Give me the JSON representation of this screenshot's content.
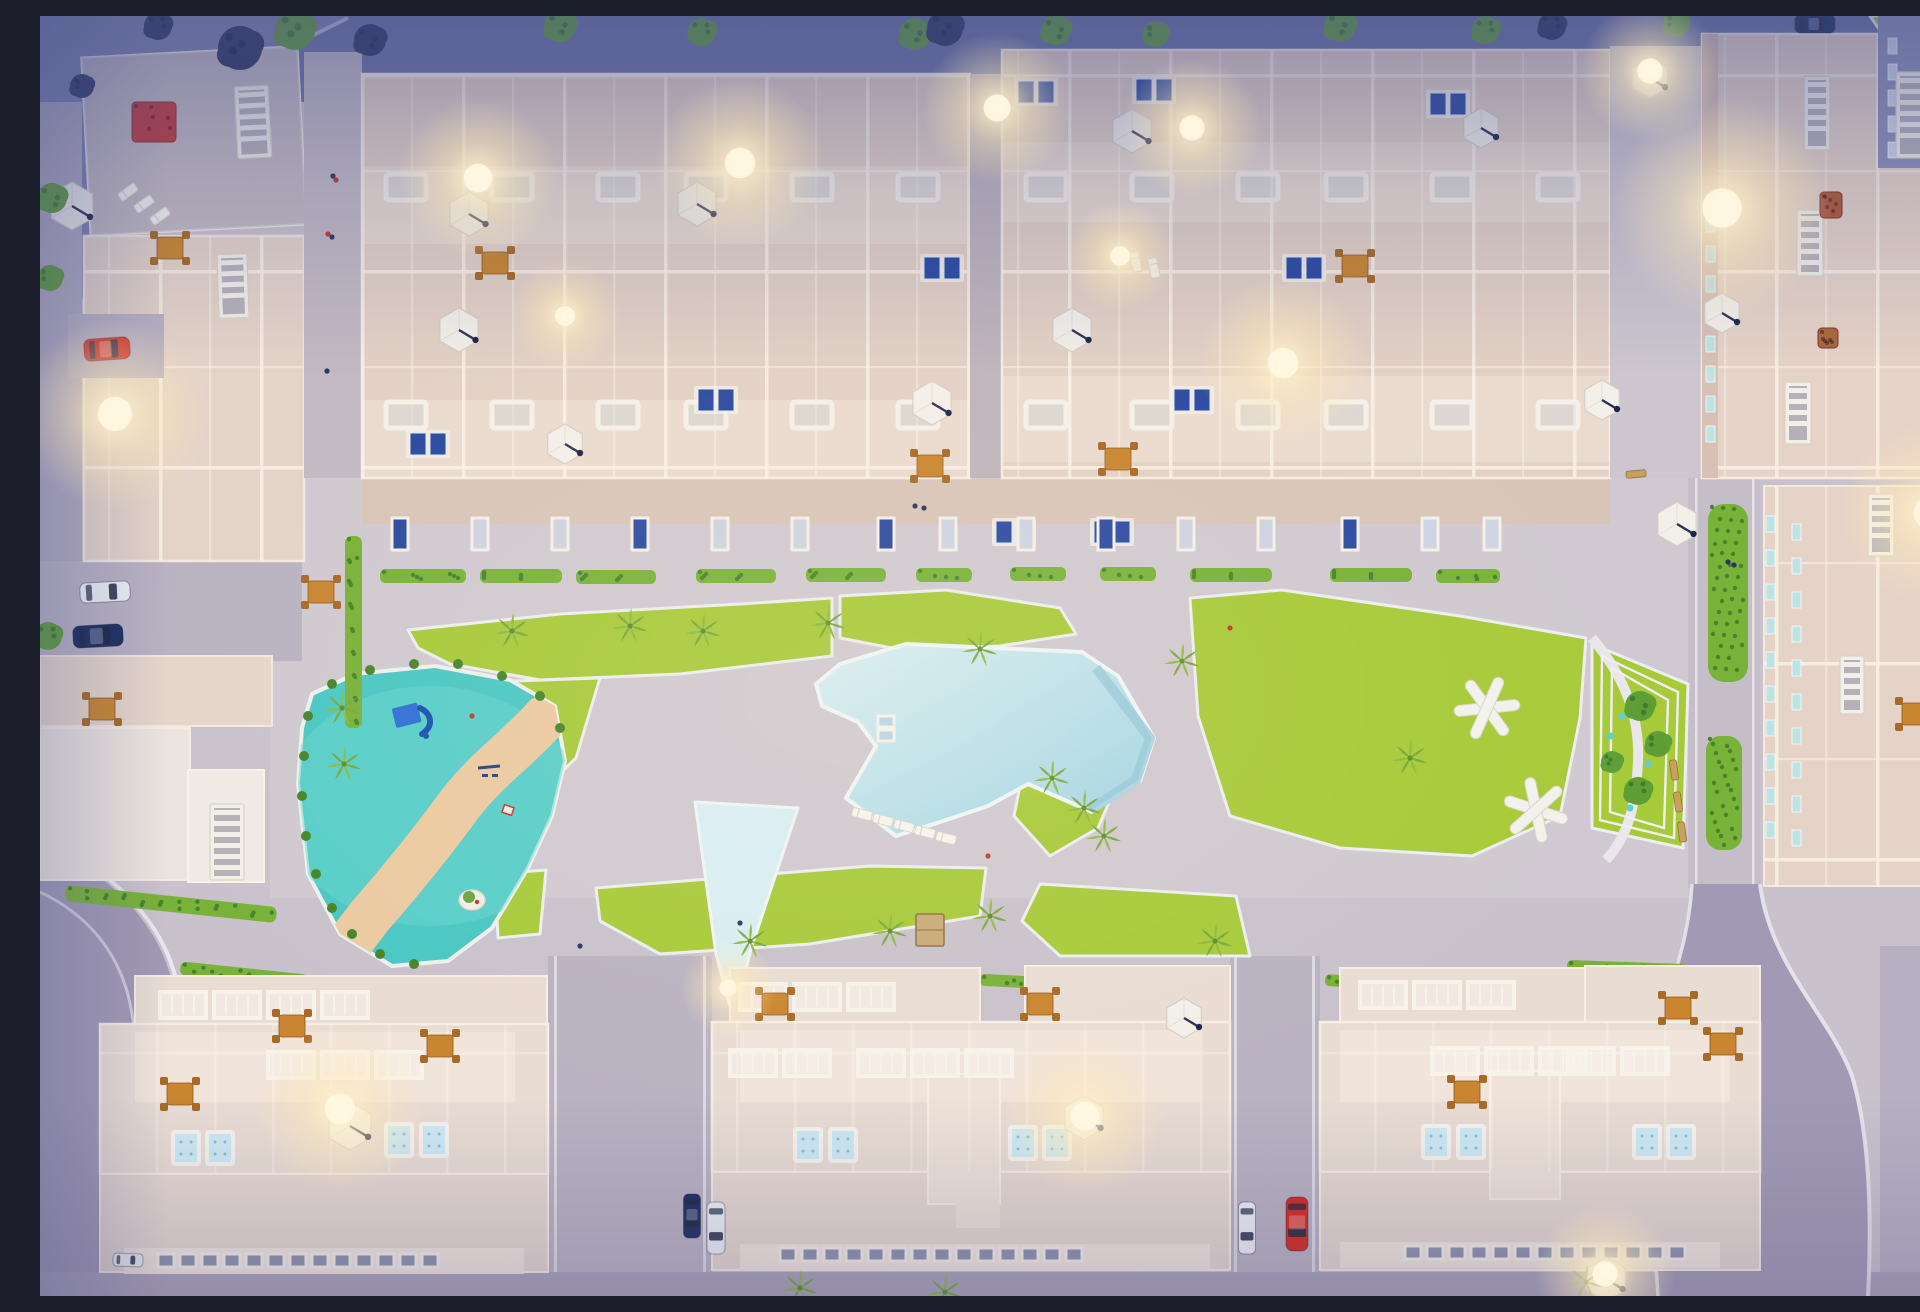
{
  "meta": {
    "title": "Aerial dusk render of residential complex",
    "description": "Top-down 3D architectural rendering at dusk: rows of cream apartment buildings with lit rooftop terraces, parasols and plunge pools around a central courtyard with a large free-form swimming pool, lawns with palm trees, a teal playground with a winding sand path, picnic structures on the right lawn, and perimeter streets with parked cars"
  },
  "palette": {
    "plaza": "#c9c2cc",
    "dusk": "#6b72a4",
    "dusk2": "#7d82ae",
    "roadPurple": "#a29ab4",
    "roadSide": "#b9b2c2",
    "brick": "#c2b9c3",
    "roofA": "#e3d1c5",
    "roofL": "#ddcfc9",
    "roofC": "#e6d3c7",
    "slab": "#e9dcd3",
    "slabLight": "#f1e4da",
    "facade": "#d9c5b8",
    "lawn": "#a7ca39",
    "hedge": "#79b238",
    "hedgeDark": "#46842a",
    "pool": "#b2dde9",
    "poolLight": "#d8eef4",
    "poolEdge": "#8fc6d8",
    "playTeal": "#49c7c3",
    "playTealLight": "#68d5d0",
    "sand": "#eccaa2",
    "umbrella": "#f3f0ea",
    "carRed": "#d4291d",
    "carBlue": "#2a4fb4",
    "carNavy": "#1c2d5e",
    "carWhite": "#eef0f4",
    "glow": "#ffe9b8",
    "treeGreen": "#5f9e37",
    "treeDark": "#3f7d2b",
    "treeNavy": "#2c3560",
    "palm": "#8fba43",
    "orange": "#c9852f",
    "panelBlue": "#2b4aa0",
    "tealWin": "#bfe3e3"
  },
  "scene": {
    "lawns": [
      {
        "points": "368,614 520,598 700,588 792,582 792,640 640,658 500,664 410,648 378,632"
      },
      {
        "points": "800,580 906,574 1020,592 1036,618 960,630 862,634 800,622"
      },
      {
        "points": "390,668 560,662 536,742 470,806 422,772 396,700"
      },
      {
        "points": "985,745 1052,736 1076,770 1058,812 1010,840 974,800"
      },
      {
        "points": "1150,582 1242,574 1420,600 1546,622 1540,702 1520,800 1432,840 1300,832 1190,800 1158,700"
      },
      {
        "points": "1552,628 1648,668 1643,832 1552,812"
      },
      {
        "points": "556,872 830,850 946,852 940,900 770,928 620,938 560,905"
      },
      {
        "points": "1000,868 1196,880 1210,940 1020,940 982,905"
      },
      {
        "points": "455,858 506,854 500,918 458,922"
      },
      {
        "points": "1896,1004 1920,998 1920,1106 1900,1108"
      },
      {
        "points": "1830,0 1920,0 1920,36 1845,22"
      }
    ],
    "pool": {
      "main": "800,648 866,628 1042,636 1078,660 1114,722 1100,765 1052,796 988,768 948,790 900,806 856,820 806,782 836,730 818,706 782,690 776,668",
      "shallow": "655,786 758,792 712,930 693,1002 676,938",
      "step_path": "M1056,652 L1110,722 L1096,764 L1050,794",
      "skylights": [
        [
          838,
          700
        ],
        [
          838,
          714
        ]
      ]
    },
    "playground": {
      "outline": "272,678 315,658 395,650 470,664 515,690 525,745 512,800 488,852 452,912 408,945 352,950 300,918 268,858 258,768 262,712",
      "sand_path": "M505,702 C472,738 448,752 420,788 C398,818 372,852 330,900 L310,926",
      "bushes": [
        [
          268,
          700
        ],
        [
          264,
          740
        ],
        [
          262,
          780
        ],
        [
          266,
          820
        ],
        [
          276,
          858
        ],
        [
          292,
          892
        ],
        [
          312,
          918
        ],
        [
          340,
          938
        ],
        [
          374,
          948
        ],
        [
          292,
          668
        ],
        [
          330,
          654
        ],
        [
          374,
          648
        ],
        [
          418,
          648
        ],
        [
          462,
          660
        ],
        [
          500,
          680
        ],
        [
          520,
          712
        ]
      ],
      "slide": [
        372,
        700
      ],
      "swing": [
        448,
        758
      ],
      "island": [
        432,
        884
      ],
      "toy": [
        468,
        794
      ]
    },
    "garden": {
      "fences": [
        "1562,640 1638,676 1634,822 1560,804",
        "1572,652 1628,684 1624,812 1570,796"
      ],
      "path": "M1552,622 C1584,660 1600,700 1598,745 C1596,790 1588,820 1566,844",
      "teal_dots": [
        [
          1582,
          700
        ],
        [
          1608,
          748
        ],
        [
          1590,
          792
        ],
        [
          1570,
          720
        ]
      ]
    },
    "hedges": [
      [
        340,
        553,
        86,
        14,
        0
      ],
      [
        440,
        553,
        82,
        14,
        0
      ],
      [
        536,
        554,
        80,
        14,
        0
      ],
      [
        656,
        553,
        80,
        14,
        0
      ],
      [
        766,
        552,
        80,
        14,
        0
      ],
      [
        876,
        552,
        56,
        14,
        0
      ],
      [
        970,
        551,
        56,
        14,
        0
      ],
      [
        1060,
        551,
        56,
        14,
        0
      ],
      [
        1150,
        552,
        82,
        14,
        0
      ],
      [
        1290,
        552,
        82,
        14,
        0
      ],
      [
        1396,
        553,
        64,
        14,
        0
      ],
      [
        305,
        520,
        17,
        192,
        0
      ],
      [
        273,
        60,
        10,
        370,
        0
      ],
      [
        25,
        880,
        212,
        16,
        6
      ],
      [
        140,
        952,
        128,
        14,
        6
      ],
      [
        705,
        962,
        56,
        12,
        3
      ],
      [
        940,
        961,
        126,
        12,
        3
      ],
      [
        1090,
        962,
        66,
        12,
        3
      ],
      [
        1285,
        960,
        74,
        12,
        3
      ],
      [
        1527,
        946,
        120,
        12,
        2
      ],
      [
        1668,
        488,
        40,
        178,
        0
      ],
      [
        1666,
        720,
        36,
        114,
        0
      ],
      [
        1590,
        170,
        10,
        290,
        0
      ],
      [
        1646,
        60,
        10,
        400,
        0
      ],
      [
        935,
        130,
        8,
        310,
        0
      ]
    ],
    "glows": [
      [
        75,
        398,
        95
      ],
      [
        438,
        162,
        80
      ],
      [
        700,
        147,
        85
      ],
      [
        957,
        92,
        75
      ],
      [
        1152,
        112,
        70
      ],
      [
        1243,
        347,
        85
      ],
      [
        1610,
        55,
        70
      ],
      [
        1682,
        192,
        110
      ],
      [
        1890,
        497,
        90
      ],
      [
        300,
        1093,
        85
      ],
      [
        1045,
        1100,
        80
      ],
      [
        1565,
        1258,
        70
      ],
      [
        688,
        972,
        48
      ],
      [
        525,
        300,
        55
      ],
      [
        1080,
        240,
        55
      ]
    ],
    "umbrellas": [
      [
        32,
        190,
        24
      ],
      [
        429,
        198,
        22
      ],
      [
        419,
        314,
        22
      ],
      [
        657,
        188,
        22
      ],
      [
        525,
        428,
        20
      ],
      [
        1092,
        115,
        22
      ],
      [
        1032,
        314,
        22
      ],
      [
        892,
        387,
        22
      ],
      [
        1441,
        112,
        20
      ],
      [
        1610,
        62,
        20
      ],
      [
        1682,
        297,
        20
      ],
      [
        1562,
        384,
        20
      ],
      [
        1637,
        508,
        22
      ],
      [
        310,
        1110,
        24
      ],
      [
        1044,
        1102,
        22
      ],
      [
        1144,
        1002,
        20
      ],
      [
        1566,
        1263,
        22
      ]
    ],
    "cars": [
      {
        "x": 67,
        "y": 333,
        "w": 46,
        "h": 22,
        "rot": -4,
        "c": "red"
      },
      {
        "x": 65,
        "y": 576,
        "w": 50,
        "h": 20,
        "rot": -3,
        "c": "white"
      },
      {
        "x": 58,
        "y": 620,
        "w": 50,
        "h": 22,
        "rot": -3,
        "c": "navy"
      },
      {
        "x": 88,
        "y": 1244,
        "w": 30,
        "h": 13,
        "rot": 2,
        "c": "white"
      },
      {
        "x": 652,
        "y": 1200,
        "w": 44,
        "h": 17,
        "rot": 90,
        "c": "navy"
      },
      {
        "x": 676,
        "y": 1212,
        "w": 52,
        "h": 18,
        "rot": 90,
        "c": "white"
      },
      {
        "x": 1207,
        "y": 1212,
        "w": 52,
        "h": 17,
        "rot": 90,
        "c": "white"
      },
      {
        "x": 1257,
        "y": 1208,
        "w": 54,
        "h": 22,
        "rot": 90,
        "c": "red"
      },
      {
        "x": 1903,
        "y": 583,
        "w": 44,
        "h": 20,
        "rot": 90,
        "c": "navy"
      },
      {
        "x": 1900,
        "y": 640,
        "w": 40,
        "h": 20,
        "rot": 90,
        "c": "blue"
      },
      {
        "x": 1775,
        "y": 8,
        "w": 40,
        "h": 18,
        "rot": 0,
        "c": "navy"
      }
    ],
    "people": [
      [
        293,
        160,
        "n"
      ],
      [
        296,
        164,
        "r"
      ],
      [
        288,
        218,
        "r"
      ],
      [
        292,
        221,
        "n"
      ],
      [
        287,
        355,
        "n"
      ],
      [
        875,
        490,
        "n"
      ],
      [
        884,
        492,
        "n"
      ],
      [
        948,
        840,
        "r"
      ],
      [
        432,
        700,
        "r"
      ],
      [
        700,
        907,
        "n"
      ],
      [
        1688,
        546,
        "n"
      ],
      [
        1694,
        549,
        "n"
      ],
      [
        1190,
        612,
        "r"
      ],
      [
        540,
        930,
        "n"
      ]
    ],
    "trees": [
      [
        255,
        14,
        20
      ],
      [
        520,
        10,
        16
      ],
      [
        662,
        16,
        14
      ],
      [
        875,
        18,
        16
      ],
      [
        1016,
        14,
        15
      ],
      [
        1116,
        18,
        13
      ],
      [
        1300,
        10,
        16
      ],
      [
        1446,
        14,
        14
      ],
      [
        1636,
        8,
        13
      ],
      [
        1906,
        30,
        16
      ],
      [
        12,
        182,
        15
      ],
      [
        10,
        262,
        13
      ],
      [
        8,
        620,
        14
      ],
      [
        1600,
        690,
        15
      ],
      [
        1618,
        728,
        13
      ],
      [
        1598,
        775,
        14
      ],
      [
        1572,
        746,
        11
      ]
    ],
    "dark_trees": [
      [
        200,
        32,
        22
      ],
      [
        330,
        24,
        16
      ],
      [
        118,
        10,
        14
      ],
      [
        905,
        12,
        18
      ],
      [
        1512,
        10,
        14
      ],
      [
        42,
        70,
        12
      ]
    ],
    "palms": [
      [
        472,
        615
      ],
      [
        590,
        610
      ],
      [
        663,
        615
      ],
      [
        788,
        607
      ],
      [
        940,
        633
      ],
      [
        1142,
        645
      ],
      [
        1012,
        762
      ],
      [
        1044,
        792
      ],
      [
        1064,
        820
      ],
      [
        1370,
        742
      ],
      [
        302,
        692
      ],
      [
        304,
        748
      ],
      [
        710,
        925
      ],
      [
        850,
        915
      ],
      [
        950,
        900
      ],
      [
        1175,
        925
      ],
      [
        760,
        1272
      ],
      [
        905,
        1276
      ],
      [
        1546,
        1266
      ]
    ],
    "skylight_rows": [
      {
        "xs": [
          352,
          452,
          552,
          652,
          752,
          852
        ],
        "ys": [
          158,
          386
        ]
      },
      {
        "xs": [
          992,
          1092,
          1192,
          1292,
          1392,
          1492
        ],
        "ys": [
          158,
          386
        ]
      }
    ],
    "panels": [
      [
        676,
        384
      ],
      [
        996,
        76
      ],
      [
        1114,
        74
      ],
      [
        974,
        516
      ],
      [
        1072,
        516
      ],
      [
        902,
        252
      ],
      [
        1264,
        252
      ],
      [
        388,
        428
      ],
      [
        1408,
        88
      ],
      [
        1152,
        384
      ]
    ],
    "doors": {
      "xs": [
        352,
        432,
        512,
        592,
        672,
        752,
        838,
        900,
        978,
        1058,
        1138,
        1218,
        1302,
        1382,
        1444
      ],
      "y": 502
    },
    "facade_windows": [
      {
        "x": 1666,
        "y0": 200,
        "n": 8,
        "dy": 30
      },
      {
        "x": 1726,
        "y0": 500,
        "n": 10,
        "dy": 34
      },
      {
        "x": 1752,
        "y0": 508,
        "n": 10,
        "dy": 34
      },
      {
        "x": 1848,
        "y0": 22,
        "n": 5,
        "dy": 26
      }
    ],
    "stairs": [
      [
        196,
        70,
        34,
        72,
        -3
      ],
      [
        178,
        238,
        30,
        64,
        -2
      ],
      [
        170,
        788,
        34,
        76,
        0
      ],
      [
        1764,
        60,
        26,
        74,
        0
      ],
      [
        1757,
        194,
        26,
        66,
        0
      ],
      [
        1745,
        366,
        26,
        62,
        0
      ],
      [
        1856,
        56,
        30,
        86,
        0
      ],
      [
        1890,
        118,
        26,
        72,
        0
      ],
      [
        1828,
        478,
        26,
        62,
        0
      ],
      [
        1800,
        640,
        24,
        58,
        0
      ]
    ],
    "flowerbeds": [
      [
        92,
        86,
        44,
        40,
        "#c03a3a"
      ],
      [
        1780,
        176,
        22,
        26,
        "#b05a35"
      ],
      [
        1778,
        312,
        20,
        20,
        "#a86a3a"
      ]
    ],
    "tables": [
      [
        281,
        576
      ],
      [
        62,
        693
      ],
      [
        140,
        1078
      ],
      [
        400,
        1030
      ],
      [
        252,
        1010
      ],
      [
        735,
        988
      ],
      [
        1000,
        988
      ],
      [
        1427,
        1076
      ],
      [
        1638,
        992
      ],
      [
        1683,
        1028
      ],
      [
        890,
        450
      ],
      [
        1078,
        443
      ],
      [
        455,
        247
      ],
      [
        1315,
        250
      ],
      [
        1875,
        698
      ],
      [
        130,
        232
      ]
    ],
    "benches": [
      [
        1634,
        754,
        82
      ],
      [
        1638,
        786,
        82
      ],
      [
        1642,
        816,
        82
      ],
      [
        1596,
        458,
        -5
      ]
    ],
    "loungers": [
      [
        822,
        798,
        14
      ],
      [
        843,
        804,
        14
      ],
      [
        864,
        810,
        14
      ],
      [
        885,
        816,
        14
      ],
      [
        906,
        822,
        14
      ],
      [
        88,
        176,
        -36
      ],
      [
        104,
        188,
        -36
      ],
      [
        120,
        200,
        -36
      ],
      [
        1096,
        246,
        78
      ],
      [
        1114,
        252,
        78
      ]
    ],
    "xstructures": [
      [
        1447,
        692,
        -18
      ],
      [
        1496,
        794,
        6
      ]
    ],
    "rooftop_pools": [
      [
        133,
        1116
      ],
      [
        167,
        1116
      ],
      [
        346,
        1108
      ],
      [
        381,
        1108
      ],
      [
        755,
        1113
      ],
      [
        790,
        1113
      ],
      [
        970,
        1111
      ],
      [
        1004,
        1111
      ],
      [
        1383,
        1110
      ],
      [
        1418,
        1110
      ],
      [
        1594,
        1110
      ],
      [
        1628,
        1110
      ]
    ],
    "railings": [
      [
        228,
        1036,
        3
      ],
      [
        690,
        1034,
        2
      ],
      [
        818,
        1034,
        3
      ],
      [
        1392,
        1032,
        3
      ],
      [
        1528,
        1032,
        2
      ],
      [
        120,
        976,
        4
      ],
      [
        700,
        968,
        3
      ],
      [
        1320,
        966,
        3
      ]
    ],
    "window_rows": [
      [
        118,
        1238,
        13
      ],
      [
        740,
        1232,
        14
      ],
      [
        1365,
        1230,
        13
      ]
    ],
    "sheds": [
      [
        876,
        898,
        28,
        32
      ]
    ]
  }
}
